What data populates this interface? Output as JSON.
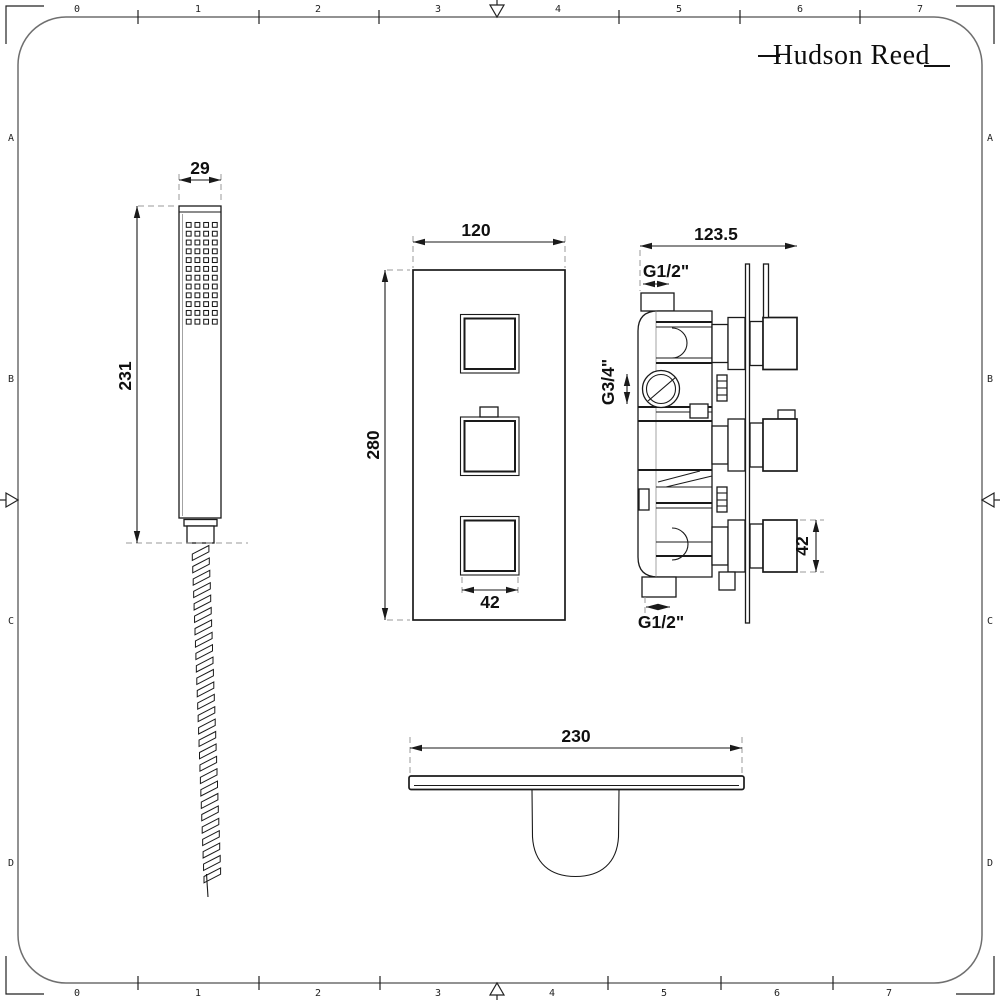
{
  "brand": {
    "name": "Hudson Reed"
  },
  "sheet": {
    "ruler_top": [
      "0",
      "1",
      "2",
      "3",
      "4",
      "5",
      "6",
      "7"
    ],
    "ruler_bottom": [
      "0",
      "1",
      "2",
      "3",
      "4",
      "5",
      "6",
      "7"
    ],
    "rows_left": [
      "A",
      "B",
      "C",
      "D"
    ],
    "rows_right": [
      "A",
      "B",
      "C",
      "D"
    ]
  },
  "dimensions": {
    "handset_width": "29",
    "handset_height": "231",
    "plate_width": "120",
    "plate_height": "280",
    "knob_front": "42",
    "valve_depth": "123.5",
    "inlet_top": "G1/2\"",
    "outlet_side": "G3/4\"",
    "inlet_bottom": "G1/2\"",
    "knob_side": "42",
    "shelf_width": "230"
  },
  "colors": {
    "ink": "#1a1a1a",
    "frame": "#6f6f6f",
    "extension_dash": "#9a9a9a",
    "paper": "#ffffff"
  }
}
